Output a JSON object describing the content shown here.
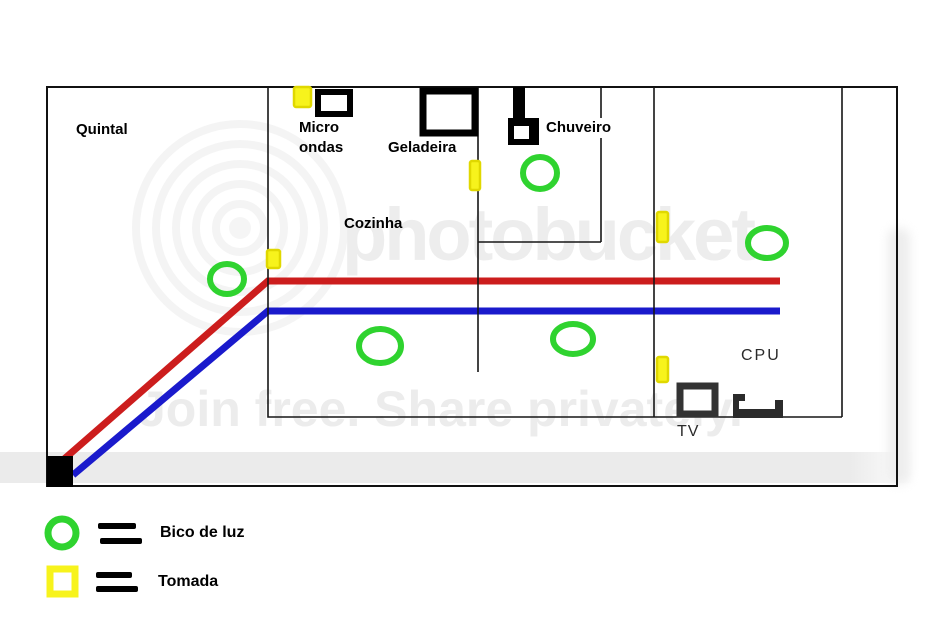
{
  "labels": {
    "quintal": "Quintal",
    "cozinha": "Cozinha",
    "micro_line1": "Micro",
    "micro_line2": "ondas",
    "geladeira": "Geladeira",
    "chuveiro": "Chuveiro",
    "cpu": "CPU",
    "tv": "TV"
  },
  "legend": {
    "bulb_label": "Bico de luz",
    "outlet_label": "Tomada"
  },
  "watermark": {
    "brand": "photobucket",
    "tagline": "Join free. Share privately."
  },
  "colors": {
    "wire_live": "#cc1d1d",
    "wire_neutral": "#1a1acc",
    "bulb_green": "#2fd32f",
    "outlet_yellow": "#f7f31c",
    "outlet_border": "#e0d800",
    "wall_black": "#111111"
  },
  "symbols": {
    "bulbs": [
      {
        "x": 227,
        "y": 279,
        "rx": 17,
        "ry": 15
      },
      {
        "x": 540,
        "y": 173,
        "rx": 17,
        "ry": 16
      },
      {
        "x": 767,
        "y": 243,
        "rx": 19,
        "ry": 15
      },
      {
        "x": 380,
        "y": 346,
        "rx": 21,
        "ry": 17
      },
      {
        "x": 573,
        "y": 339,
        "rx": 20,
        "ry": 15
      }
    ],
    "outlets": [
      {
        "x": 294,
        "y": 87,
        "w": 17,
        "h": 20
      },
      {
        "x": 470,
        "y": 161,
        "w": 10,
        "h": 29
      },
      {
        "x": 267,
        "y": 250,
        "w": 13,
        "h": 18
      },
      {
        "x": 657,
        "y": 212,
        "w": 11,
        "h": 30
      },
      {
        "x": 657,
        "y": 357,
        "w": 11,
        "h": 25
      }
    ]
  }
}
